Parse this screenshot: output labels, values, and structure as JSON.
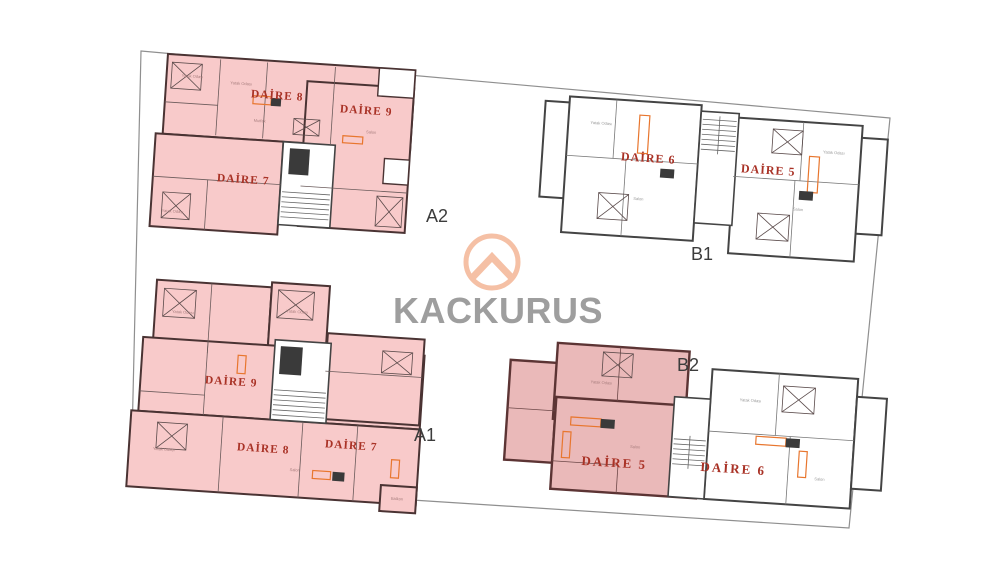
{
  "watermark": {
    "brand": "KACKURUS"
  },
  "site": {
    "type": "floor-plan-sheet",
    "boundary": "site parcel outline"
  },
  "buildings": {
    "a2": {
      "code": "A2",
      "units": {
        "daire8": "DAİRE 8",
        "daire9": "DAİRE 9",
        "daire7": "DAİRE 7"
      },
      "rooms": [
        "Yatak Odası",
        "Yatak Odası",
        "Mutfak",
        "Yatak Odası",
        "Salon"
      ]
    },
    "b1": {
      "code": "B1",
      "units": {
        "daire6": "DAİRE 6",
        "daire5": "DAİRE 5"
      },
      "rooms": [
        "Yatak Odası",
        "Salon",
        "Salon",
        "Yatak Odası"
      ]
    },
    "a1": {
      "code": "A1",
      "units": {
        "daire9": "DAİRE 9",
        "daire8": "DAİRE 8",
        "daire7": "DAİRE 7"
      },
      "rooms": [
        "Yatak Odası",
        "Yatak Odası",
        "Yatak Odası",
        "Salon",
        "Balkon"
      ]
    },
    "b2": {
      "code": "B2",
      "units": {
        "daire5": "DAİRE 5",
        "daire6": "DAİRE 6"
      },
      "rooms": [
        "Yatak Odası",
        "Salon",
        "Yatak Odası",
        "Salon"
      ]
    }
  },
  "highlighted_units": [
    "A2 DAİRE 8",
    "A2 DAİRE 9",
    "A2 DAİRE 7",
    "A1 DAİRE 9",
    "A1 DAİRE 8",
    "A1 DAİRE 7",
    "B2 DAİRE 5"
  ],
  "colors": {
    "site-stroke": "#8f8f8f",
    "pink-fill": "#f8caca",
    "pink-wall": "#4a3333",
    "white-fill": "#ffffff",
    "plan-wall": "#444444",
    "highlight-fill": "#eab9b9",
    "highlight-wall": "#5c3434",
    "unit-label": "#a93226",
    "code-label": "#3c3c3c",
    "fixture-orange": "#e8762e",
    "logo-peach": "#f5c0a5",
    "logo-gray": "#9e9e9e"
  }
}
